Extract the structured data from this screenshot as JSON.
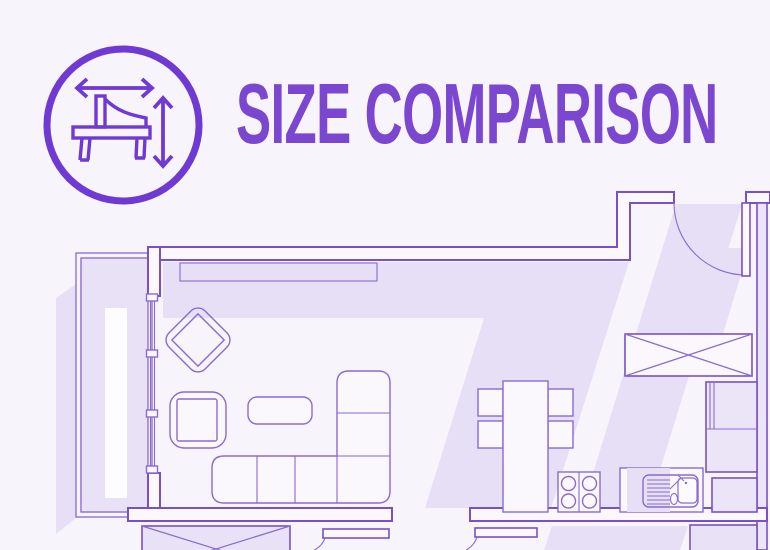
{
  "header": {
    "title": "SIZE COMPARISON",
    "icon": "piano-with-measurement-arrows"
  },
  "colors": {
    "bg": "#f7f4fb",
    "accent": "#6f3ad3",
    "title-color": "#7b47d0",
    "line": "#7a50c8",
    "furn-line": "#8b6ad0",
    "shadow": "#e7dff5",
    "room-fill": "#e9e2f6"
  },
  "floorplan": {
    "type": "apartment-floor-plan",
    "rooms": [
      "balcony",
      "living-room",
      "open-kitchen-dining",
      "entry",
      "adjacent-rooms"
    ],
    "elements": [
      "window-wall",
      "window-bench",
      "lounge-chair",
      "armchair",
      "coffee-table",
      "corner-sofa",
      "wardrobe-crossed",
      "entry-door-swing",
      "dining-table",
      "dining-chairs",
      "stove-four-burners",
      "double-sink-with-faucet",
      "kitchen-cabinets",
      "storage-box-crossed",
      "interior-door-leaves"
    ]
  }
}
